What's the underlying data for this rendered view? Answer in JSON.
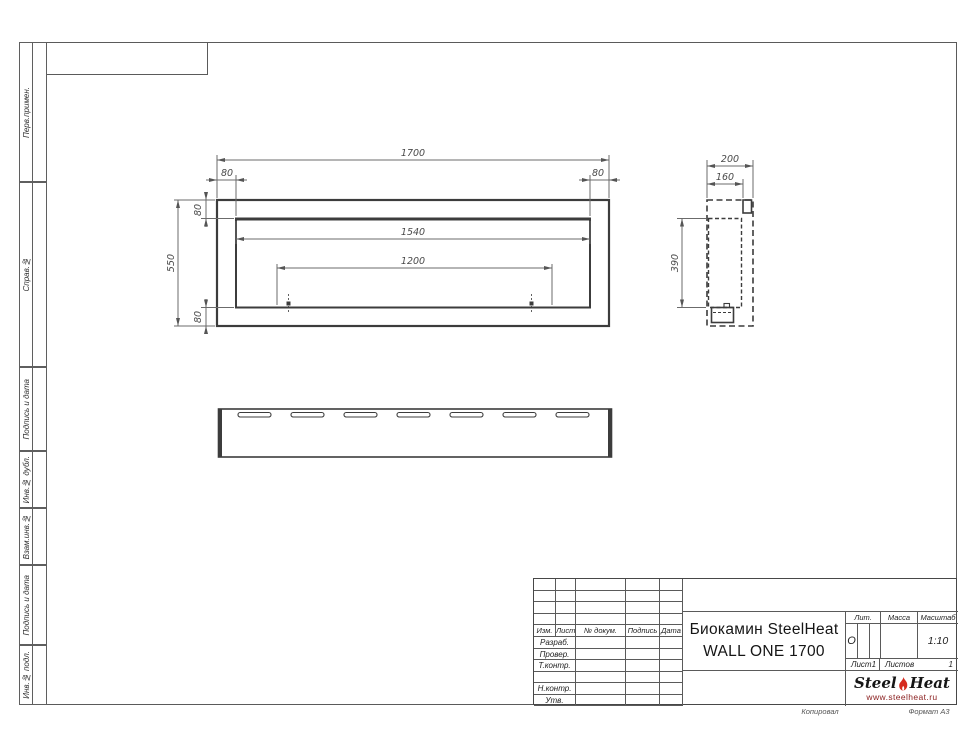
{
  "sidebar": {
    "sections": [
      {
        "label": "Перв.примен."
      },
      {
        "label": "Справ.№"
      },
      {
        "label": "Подпись и дата"
      },
      {
        "label": "Инв.№ дубл."
      },
      {
        "label": "Взам.инв.№"
      },
      {
        "label": "Подпись и дата"
      },
      {
        "label": "Инв.№ подл."
      }
    ]
  },
  "drawing": {
    "dims": {
      "front_total": "1700",
      "front_offset_left": "80",
      "front_offset_right": "80",
      "front_offset_top": "80",
      "front_offset_bottom": "80",
      "front_height": "550",
      "front_inner_width": "1540",
      "front_mount_span": "1200",
      "side_depth": "200",
      "side_inner_depth": "160",
      "side_inner_height": "390"
    }
  },
  "title_block": {
    "change_header": {
      "izm": "Изм.",
      "list": "Лист",
      "doc": "№ докум.",
      "sign": "Подпись",
      "date": "Дата"
    },
    "roles": [
      "Разраб.",
      "Провер.",
      "Т.контр.",
      "",
      "Н.контр.",
      "Утв."
    ],
    "title_line1": "Биокамин SteelHeat",
    "title_line2": "WALL ONE 1700",
    "lit_label": "Лит.",
    "lit_value": "О",
    "mass_label": "Масса",
    "scale_label": "Масштаб",
    "scale_value": "1:10",
    "sheet_label": "Лист",
    "sheet_value": "1",
    "sheets_label": "Листов",
    "sheets_value": "1",
    "logo": {
      "steel": "Steel",
      "heat": "Heat",
      "url": "www.steelheat.ru"
    }
  },
  "footer": {
    "copied": "Копировал",
    "format": "Формат А3"
  }
}
